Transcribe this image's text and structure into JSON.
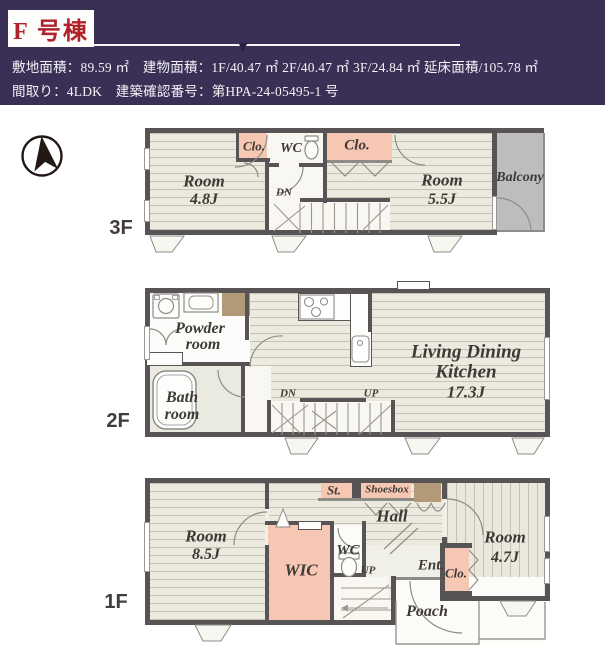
{
  "header": {
    "building": "F 号棟",
    "spec_line1": "敷地面積：89.59 ㎡　建物面積：1F/40.47 ㎡ 2F/40.47 ㎡ 3F/24.84 ㎡ 延床面積/105.78 ㎡",
    "spec_line2": "間取り：4LDK　建築確認番号：第HPA-24-05495-1 号"
  },
  "colors": {
    "header_bg": "#3a3056",
    "accent_red": "#b0212b",
    "wall": "#585456",
    "closet_pink": "#f6c7b3",
    "fixture_tan": "#b29978",
    "balcony_gray": "#bcbdbc"
  },
  "floors": {
    "f3": {
      "floor_label": "3F",
      "room_a_name": "Room",
      "room_a_size": "4.8J",
      "closet_small": "Clo.",
      "wc": "WC",
      "closet_large": "Clo.",
      "room_b_name": "Room",
      "room_b_size": "5.5J",
      "balcony": "Balcony",
      "stairs_dn": "DN"
    },
    "f2": {
      "floor_label": "2F",
      "powder_line1": "Powder",
      "powder_line2": "room",
      "bath_line1": "Bath",
      "bath_line2": "room",
      "ldk_line1": "Living Dining",
      "ldk_line2": "Kitchen",
      "ldk_size": "17.3J",
      "stairs_dn": "DN",
      "stairs_up": "UP"
    },
    "f1": {
      "floor_label": "1F",
      "room_a_name": "Room",
      "room_a_size": "8.5J",
      "wic": "WIC",
      "wc": "WC",
      "st": "St.",
      "shoesbox": "Shoesbox",
      "hall": "Hall",
      "ent": "Ent.",
      "closet": "Clo.",
      "room_b_name": "Room",
      "room_b_size": "4.7J",
      "stairs_up": "UP",
      "porch": "Poach"
    }
  }
}
